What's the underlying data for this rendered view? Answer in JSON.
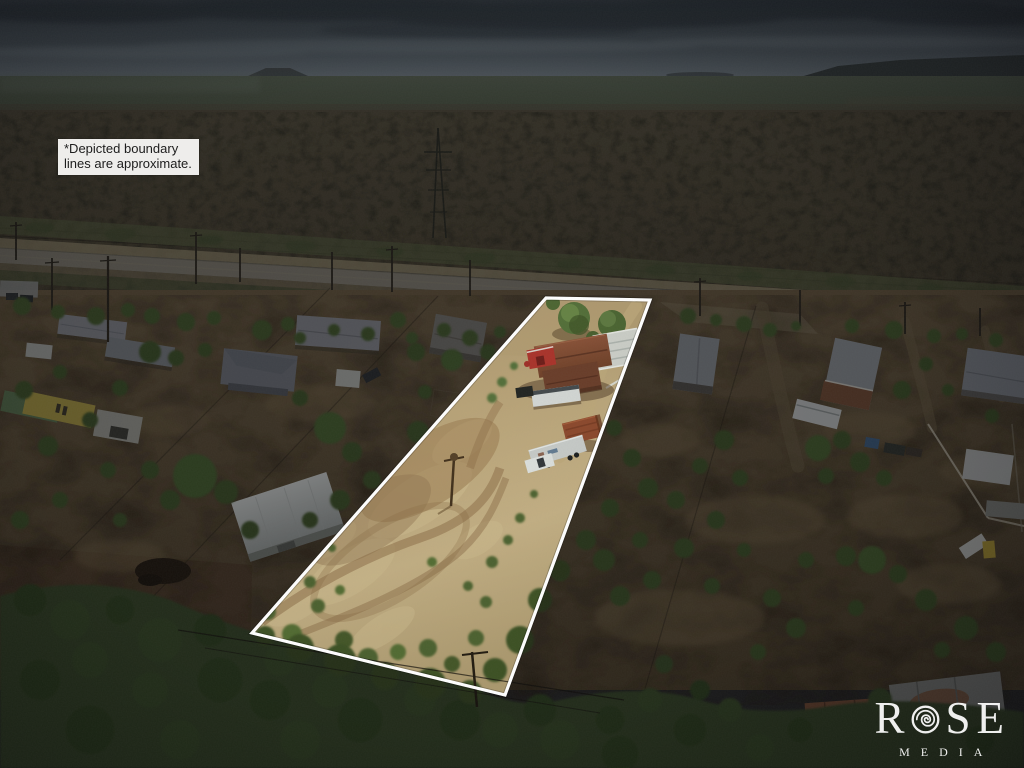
{
  "disclaimer": {
    "line1": "*Depicted boundary",
    "line2": "lines are approximate."
  },
  "watermark": {
    "brand_prefix": "R",
    "brand_suffix": "SE",
    "subtitle": "MEDIA",
    "icon": "rose-icon"
  },
  "colors": {
    "boundary_line": "#ffffff",
    "disclaimer_background": "#eeedeb",
    "disclaimer_text": "#1d1d1d",
    "watermark_text": "#ffffff"
  }
}
